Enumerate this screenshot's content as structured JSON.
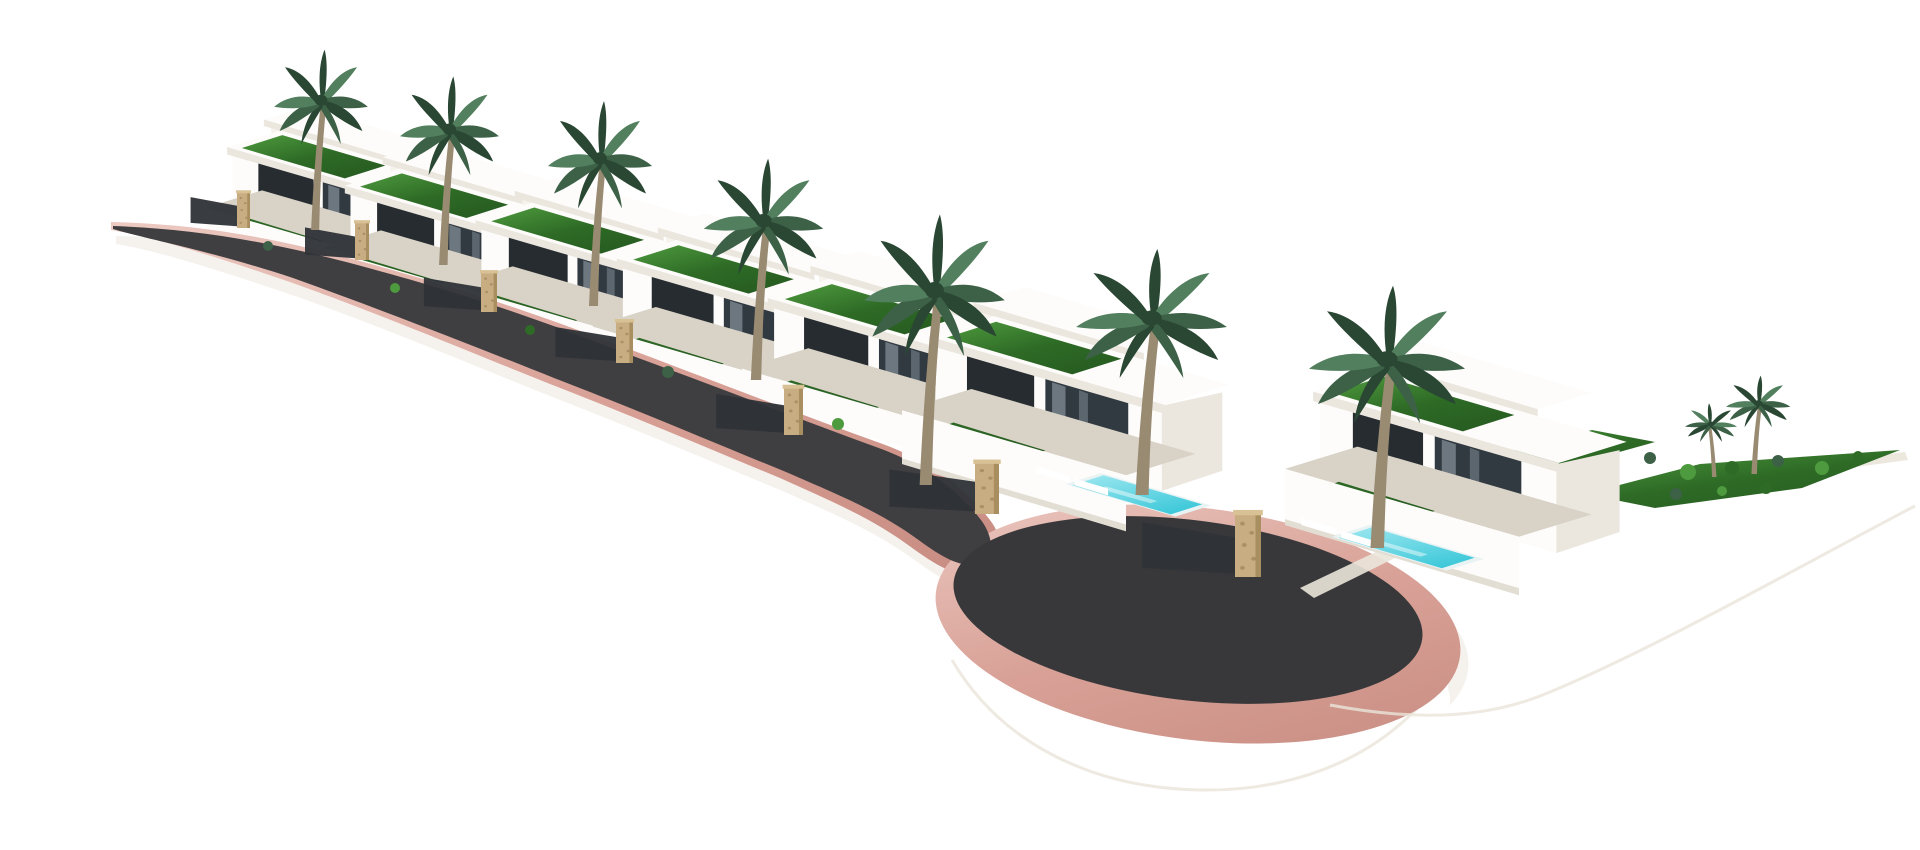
{
  "scene": {
    "description": "3D architectural rendering of a terraced hillside development: seven white modern flat-roof villas with green lawn roofs, palm trees, turquoise pools and stone gate pillars along a curved dark asphalt private road with pink curbs that ends in a rounded cul-de-sac, all on a plain white background",
    "background_color": "#ffffff",
    "villa_count": 7
  },
  "colors": {
    "bg": "#ffffff",
    "white": "#ffffff",
    "asphalt": "#3f3f41",
    "asphalt_dark": "#38383a",
    "curb": "#d8a096",
    "curb_light": "#eccac2",
    "curb_deep": "#c98e84",
    "stone": "#c9ad82",
    "stone_dark": "#8f7852",
    "stone_edge": "#a98f60",
    "stone_cap": "#d8c194",
    "gate": "#2e3338",
    "lawn": "#2e6b26",
    "lawn_light": "#4e9a3e",
    "lawn_deep": "#275c21",
    "palm": "#3c6147",
    "palm_dark": "#2a4733",
    "palm_light": "#527f5e",
    "trunk": "#998a72",
    "wall": "#fdfcfa",
    "wall_warm": "#f6f3ec",
    "wall_shade": "#ebe7df",
    "wall_shade2": "#dcd6ca",
    "concrete": "#d9d3c7",
    "glass": "#272c31",
    "glass_mid": "#323a41",
    "glass_light": "#77838c",
    "mullion": "#9aa4ab",
    "pool": "#3fc9da",
    "pool_light": "#9fe8f0",
    "pool_deck": "#e9f3f4",
    "shadow_soft": "#e9e2d8",
    "edge_faint": "#eae5da"
  },
  "road": {
    "curb_d": "M 111,222 C 200,224 280,238 385,268 C 495,299 555,321 645,355 C 740,391 815,420 880,443 C 930,461 965,487 990,520 C 1000,533 1003,548 1000,565 C 975,585 950,575 915,550 C 875,520 840,505 780,478 C 705,447 635,417 550,384 C 460,348 380,314 290,282 C 205,253 148,236 111,230 Z",
    "asphalt_d": "M 113,226 C 200,229 280,243 383,272 C 492,302 552,325 641,359 C 736,394 812,424 876,447 C 924,464 957,489 981,520 C 990,532 993,545 990,558 C 970,572 950,563 920,541 C 882,513 846,498 786,472 C 710,441 640,411 554,378 C 464,342 382,310 293,278 C 208,250 150,240 113,229 Z",
    "shadow_offset": [
      5,
      14
    ],
    "culdesac": {
      "rim": {
        "cx": 1198,
        "cy": 624,
        "rx": 264,
        "ry": 116,
        "rot": 7
      },
      "asphalt": {
        "cx": 1188,
        "cy": 610,
        "rx": 236,
        "ry": 90,
        "rot": 7
      },
      "cyl": {
        "cx": 1198,
        "cy": 700,
        "rx": 252,
        "ry": 92
      },
      "bridge": {
        "x": 948,
        "y": 624,
        "w": 500,
        "h": 80
      },
      "shadow_offset": [
        8,
        14
      ],
      "bottom_edge_d": "M 952,660 C 1000,742 1090,788 1200,790 C 1312,792 1402,744 1446,670"
    }
  },
  "villas": [
    {
      "x": 205,
      "y": 252,
      "s": 0.92,
      "pool": false,
      "layer": 0
    },
    {
      "x": 322,
      "y": 294,
      "s": 0.95,
      "pool": false,
      "layer": 0
    },
    {
      "x": 452,
      "y": 332,
      "s": 0.98,
      "pool": false,
      "layer": 0
    },
    {
      "x": 592,
      "y": 376,
      "s": 1.03,
      "pool": false,
      "layer": 0
    },
    {
      "x": 742,
      "y": 420,
      "s": 1.07,
      "pool": true,
      "layer": 0,
      "pool_shift": [
        0,
        0
      ]
    },
    {
      "x": 902,
      "y": 464,
      "s": 1.12,
      "pool": true,
      "layer": 1,
      "pool_shift": [
        0,
        -14
      ]
    },
    {
      "x": 1285,
      "y": 525,
      "s": 1.17,
      "pool": true,
      "layer": 1,
      "pool_shift": [
        -106,
        -22
      ]
    }
  ],
  "palms": [
    {
      "x": 312,
      "y": 230,
      "sx": 0.9,
      "sy": 1.1
    },
    {
      "x": 440,
      "y": 265,
      "sx": 0.95,
      "sy": 1.15
    },
    {
      "x": 590,
      "y": 306,
      "sx": 1.0,
      "sy": 1.25
    },
    {
      "x": 752,
      "y": 380,
      "sx": 1.15,
      "sy": 1.35
    },
    {
      "x": 921,
      "y": 485,
      "sx": 1.35,
      "sy": 1.65
    },
    {
      "x": 1137,
      "y": 495,
      "sx": 1.45,
      "sy": 1.5
    },
    {
      "x": 1372,
      "y": 548,
      "sx": 1.5,
      "sy": 1.6
    },
    {
      "x": 1752,
      "y": 474,
      "sx": 0.62,
      "sy": 0.6
    },
    {
      "x": 1716,
      "y": 477,
      "sx": 0.5,
      "sy": 0.45,
      "flip": true
    }
  ],
  "pillars": [
    {
      "x": 237,
      "y": 192,
      "w": 13,
      "h": 36
    },
    {
      "x": 355,
      "y": 222,
      "w": 14,
      "h": 38
    },
    {
      "x": 481,
      "y": 272,
      "w": 16,
      "h": 40
    },
    {
      "x": 616,
      "y": 321,
      "w": 17,
      "h": 42
    },
    {
      "x": 784,
      "y": 387,
      "w": 19,
      "h": 48
    },
    {
      "x": 975,
      "y": 462,
      "w": 24,
      "h": 52
    },
    {
      "x": 1235,
      "y": 513,
      "w": 26,
      "h": 64
    }
  ],
  "plateau": {
    "walkway_points": "1300,588 1468,508 1905,452 1908,460 1476,518 1314,598",
    "cliff_d": "M 1330,705 C 1420,722 1490,718 1550,692 C 1660,646 1800,566 1915,506",
    "lawns": [
      "1448,468 1592,430 1655,442 1512,482",
      "1585,494 1700,464 1900,450 1802,488 1655,508",
      "1322,520 1420,505 1452,515 1354,532"
    ],
    "shrubs": [
      [
        268,
        246,
        5
      ],
      [
        395,
        288,
        5
      ],
      [
        530,
        330,
        5
      ],
      [
        668,
        372,
        6
      ],
      [
        838,
        424,
        6
      ],
      [
        1018,
        488,
        6
      ],
      [
        1448,
        492,
        6
      ],
      [
        1492,
        486,
        5
      ],
      [
        1612,
        468,
        7
      ],
      [
        1650,
        458,
        6
      ],
      [
        1688,
        472,
        8
      ],
      [
        1732,
        468,
        7
      ],
      [
        1778,
        461,
        6
      ],
      [
        1822,
        468,
        7
      ],
      [
        1858,
        456,
        5
      ],
      [
        1676,
        494,
        6
      ],
      [
        1722,
        491,
        5
      ],
      [
        1766,
        488,
        6
      ]
    ]
  }
}
